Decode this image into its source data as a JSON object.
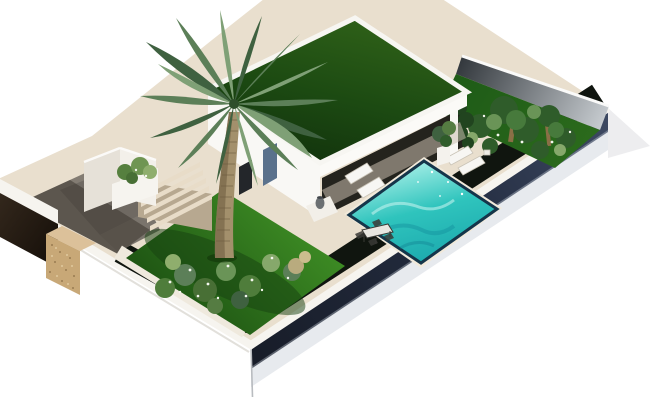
{
  "scene": {
    "type": "architectural-3d-render",
    "elements": [
      "modern-villa",
      "grass-roof",
      "palm-tree",
      "swimming-pool",
      "sun-loungers",
      "outdoor-dining-set",
      "front-lawn",
      "flower-bushes",
      "driveway",
      "entrance-steps",
      "stone-gate-pillar",
      "boundary-walls",
      "back-garden",
      "planter-box",
      "potted-plant"
    ]
  },
  "colors": {
    "background": "#ffffff",
    "plot_deck": "#e9dfce",
    "rim_white": "#f6f4ef",
    "border_dark": "#10150f",
    "roof_grass_edge": "#2e6018",
    "roof_grass_dark": "#13350d",
    "lawn_light": "#3f8f25",
    "lawn_dark": "#1e5413",
    "house_white": "#f9f8f5",
    "house_shadow": "#e3ded6",
    "glass_dark": "#24231d",
    "pool_light": "#9fece4",
    "pool_mid": "#2fc4bd",
    "pool_deep": "#1ba8ad",
    "pool_rim": "#15354a",
    "wall_navy_dark": "#181d29",
    "wall_navy_light": "#3e4a63",
    "wall_grey_dark": "#33383d",
    "wall_grey_light": "#cdd2d6",
    "gate_wall": "#241a12",
    "pillar_stone": "#c8a877",
    "pillar_stone_top": "#dcc19a",
    "driveway": "#837c73",
    "driveway_shadow": "#3c362f",
    "step_tread": "#e8dcc8",
    "step_riser": "#b7a890",
    "path_white": "#efe9dd",
    "palm_trunk": "#a3906c",
    "palm_trunk_shadow": "#7c6a4c",
    "frond_dark": "#3f6140",
    "frond_mid": "#5c7f58",
    "frond_light": "#7fa076",
    "shrub_green": "#4f7d3b",
    "shrub_light": "#8fae6d",
    "shrub_pale": "#b9ab7e",
    "flower_white": "#f4f7ee",
    "furniture_white": "#f7f6f3",
    "furniture_dark": "#3a3a36",
    "door_blue": "#5a718c",
    "window_dark": "#23262a"
  }
}
